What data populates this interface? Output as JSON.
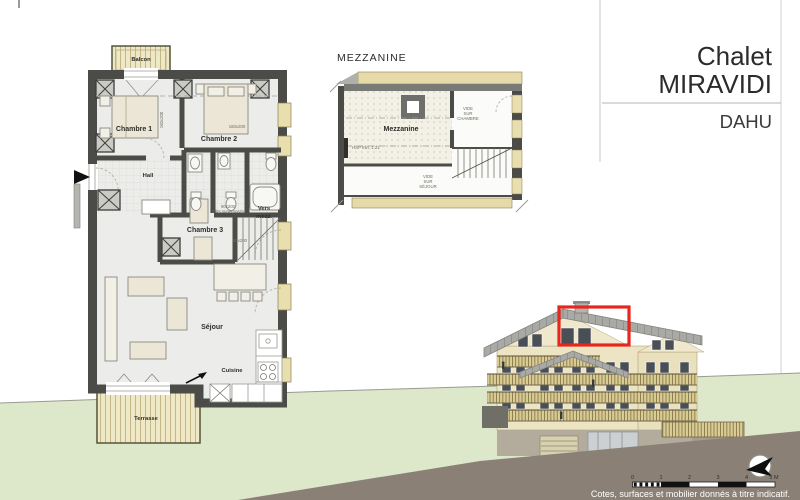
{
  "header": {
    "project_name_line1": "Chalet",
    "project_name_line2": "MIRAVIDI",
    "apartment_name": "DAHU"
  },
  "floor_plan": {
    "balcon": "Balcon",
    "chambre1": "Chambre 1",
    "chambre2": "Chambre 2",
    "hall": "Hall",
    "chambre3": "Chambre 3",
    "vers_mezz_line1": "Vers",
    "vers_mezz_line2": "mezz.",
    "sejour": "Séjour",
    "cuisine": "Cuisine",
    "terrasse": "Terrasse",
    "bed1_size": "160x200",
    "bed2_size": "160x200",
    "bed3_size": "90x200",
    "bed3_note": "2 lits superposés",
    "bed4_size": "90x200"
  },
  "mezzanine_plan": {
    "title": "MEZZANINE",
    "room": "Mezzanine",
    "hsp_note": "HSP min. 1.21",
    "void_chambre": [
      "VIDE",
      "SUR",
      "CHAMBRE"
    ],
    "void_sejour": [
      "VIDE",
      "SUR",
      "SÉJOUR"
    ]
  },
  "elevation": {
    "scale_ticks": [
      "0",
      "1",
      "2",
      "3",
      "4",
      "5 M"
    ],
    "disclaimer": "Cotes, surfaces et mobilier donnés à titre indicatif."
  },
  "colors": {
    "wall": "#4b4b48",
    "wood": "#efe8c6",
    "grass": "#dde7c9",
    "ground": "#8a8076",
    "roof": "#a8a8a6",
    "facade": "#ece4c2",
    "highlight": "#e8261d"
  }
}
